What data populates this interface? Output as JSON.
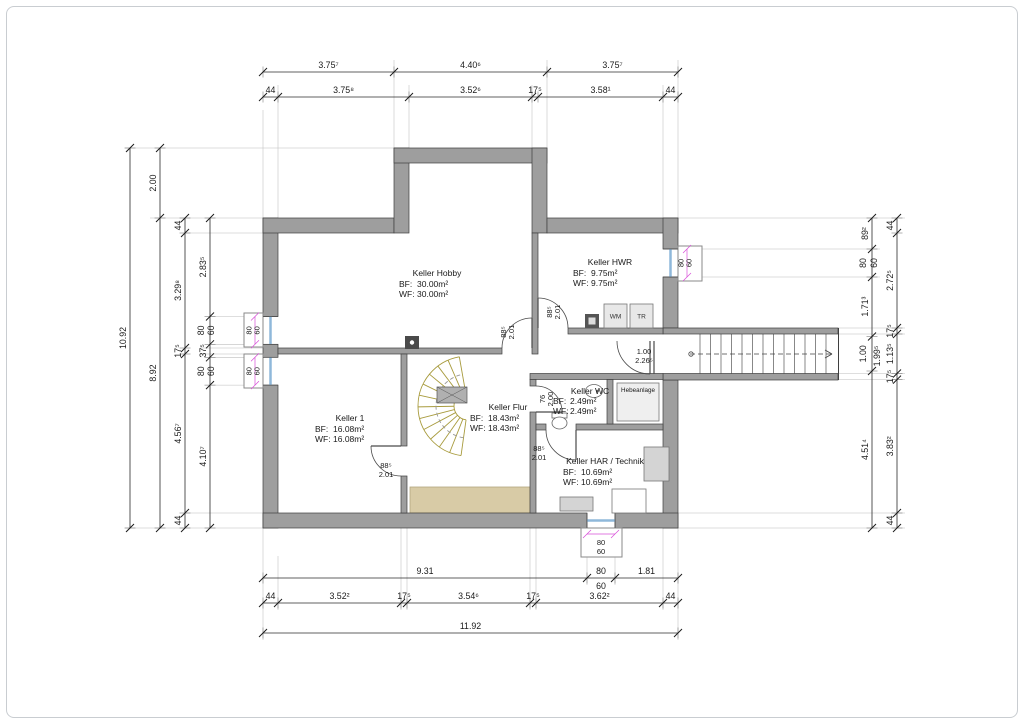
{
  "rooms": {
    "hobby": {
      "name": "Keller Hobby",
      "bf_label": "BF:",
      "bf": "30.00m²",
      "wf_label": "WF:",
      "wf": "30.00m²"
    },
    "hwr": {
      "name": "Keller HWR",
      "bf_label": "BF:",
      "bf": "9.75m²",
      "wf_label": "WF:",
      "wf": "9.75m²"
    },
    "keller1": {
      "name": "Keller 1",
      "bf_label": "BF:",
      "bf": "16.08m²",
      "wf_label": "WF:",
      "wf": "16.08m²"
    },
    "flur": {
      "name": "Keller Flur",
      "bf_label": "BF:",
      "bf": "18.43m²",
      "wf_label": "WF:",
      "wf": "18.43m²"
    },
    "wc": {
      "name": "Keller WC",
      "bf_label": "BF:",
      "bf": "2.49m²",
      "wf_label": "WF:",
      "wf": "2.49m²"
    },
    "har": {
      "name": "Keller HAR / Technik",
      "bf_label": "BF:",
      "bf": "10.69m²",
      "wf_label": "WF:",
      "wf": "10.69m²"
    },
    "hebeanlage": {
      "name": "Hebeanlage"
    }
  },
  "appliances": {
    "wm": "WM",
    "tr": "TR"
  },
  "doors": {
    "hobby": [
      "88⁵",
      "2.01"
    ],
    "hwr": [
      "88⁵",
      "2.01"
    ],
    "exit": [
      "1.00",
      "2.26⁵"
    ],
    "wc": [
      "76",
      "2.00"
    ],
    "keller1": [
      "88⁵",
      "2.01"
    ],
    "har": [
      "88⁵",
      "2.01"
    ]
  },
  "windows": {
    "left_upper": [
      "80",
      "60"
    ],
    "left_lower": [
      "80",
      "60"
    ],
    "right": [
      "80",
      "60"
    ],
    "bottom": [
      "80",
      "60"
    ]
  },
  "dims": {
    "top1": [
      "3.75⁷",
      "4.40⁶",
      "3.75⁷"
    ],
    "top2": [
      "44",
      "3.75⁸",
      "3.52⁶",
      "17⁵",
      "3.58¹",
      "44"
    ],
    "bottom1": [
      "9.31",
      "80",
      "60",
      "1.81"
    ],
    "bottom2": [
      "44",
      "3.52²",
      "17⁵",
      "3.54⁶",
      "17⁵",
      "3.62²",
      "44"
    ],
    "bottom3": "11.92",
    "left1": "10.92",
    "left2": [
      "2.00",
      "8.92"
    ],
    "left3": [
      "44",
      "3.29⁸",
      "17⁵",
      "4.56⁷",
      "44"
    ],
    "left4": [
      "2.83⁵",
      "80",
      "60",
      "37⁵",
      "80",
      "60",
      "4.10⁷"
    ],
    "rightA": [
      "89²",
      "80",
      "60",
      "1.71³",
      "1.00",
      "4.51⁴"
    ],
    "rightA_extra": "1.99⁵",
    "rightB": [
      "44",
      "2.72⁵",
      "17⁵",
      "1.13⁵",
      "17⁵",
      "3.83²",
      "44"
    ]
  },
  "colors": {
    "wall": "#9e9e9e",
    "annotation_pink": "#d84fd8",
    "window_blue": "#8fb8da",
    "stair_olive": "#a89b3d",
    "ramp_beige": "#d8cba6"
  }
}
